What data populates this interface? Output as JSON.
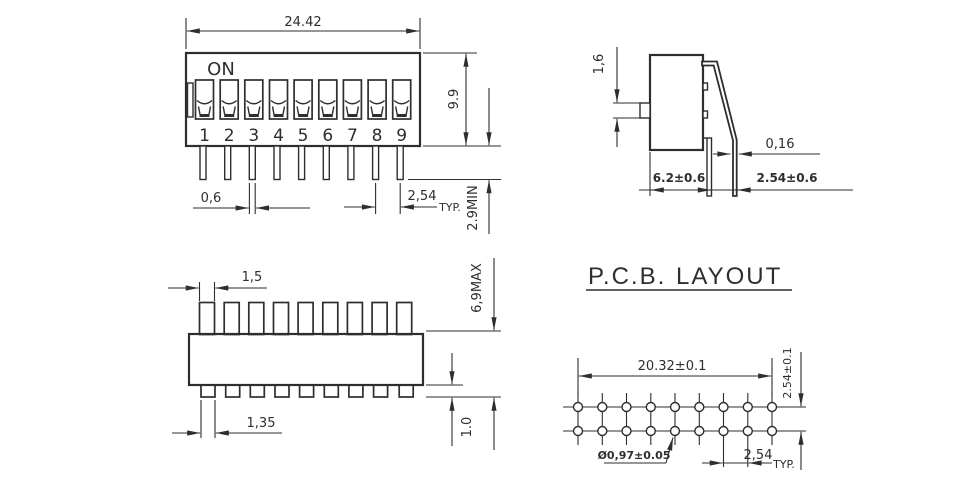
{
  "front": {
    "on_label": "ON",
    "positions": [
      "1",
      "2",
      "3",
      "4",
      "5",
      "6",
      "7",
      "8",
      "9"
    ],
    "dim_width": "24.42",
    "dim_height": "9.9",
    "dim_pin_protrusion": "2.9MIN",
    "dim_pin_width": "0,6",
    "dim_pitch": "2,54",
    "dim_pitch_qualifier": "TYP."
  },
  "side": {
    "dim_actuator_height": "1,6",
    "dim_pin_thickness": "0,16",
    "dim_body_depth": "6.2±0.6",
    "dim_pin_spacing": "2.54±0.6"
  },
  "top": {
    "dim_actuator_width": "1,5",
    "dim_overall_height": "6,9MAX",
    "dim_pin_tab_width": "1,35",
    "dim_pin_tab_height": "1.0"
  },
  "pcb": {
    "title_part1": "P.C.B.",
    "title_part2": "LAYOUT",
    "dim_hole_span": "20.32±0.1",
    "dim_row_pitch": "2.54±0.1",
    "dim_hole_diameter": "Ø0,97±0.05",
    "dim_hole_pitch": "2,54",
    "dim_hole_pitch_qualifier": "TYP."
  },
  "colors": {
    "line": "#2e2e2e",
    "background": "#ffffff"
  }
}
